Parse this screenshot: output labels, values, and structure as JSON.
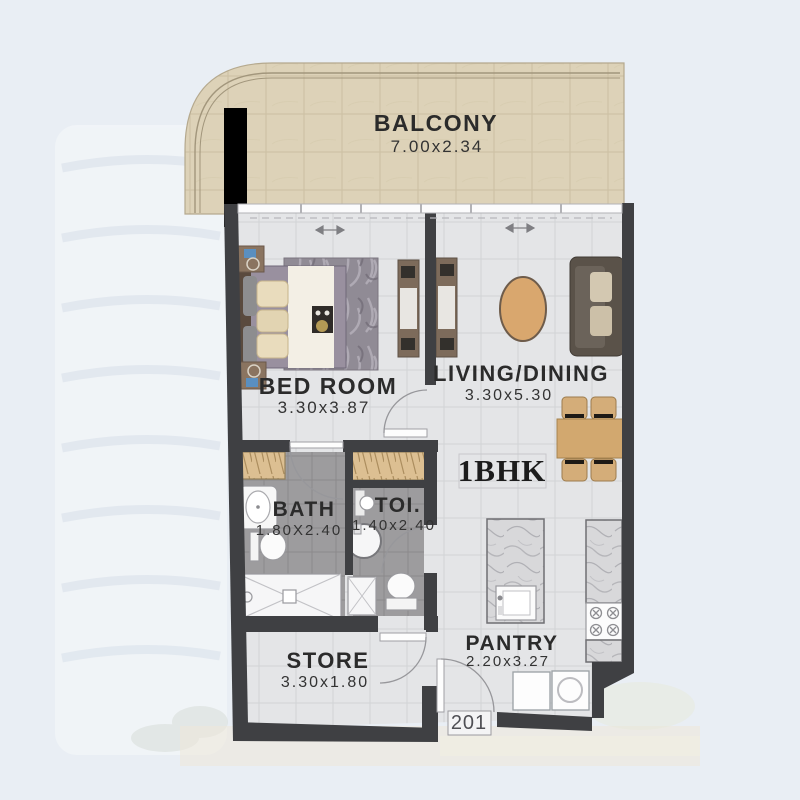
{
  "unit": {
    "type": "1BHK",
    "number": "201"
  },
  "rooms": {
    "balcony": {
      "name": "BALCONY",
      "dims": "7.00x2.34"
    },
    "bedroom": {
      "name": "BED ROOM",
      "dims": "3.30x3.87"
    },
    "living": {
      "name": "LIVING/DINING",
      "dims": "3.30x5.30"
    },
    "bath": {
      "name": "BATH",
      "dims": "1.80X2.40"
    },
    "toilet": {
      "name": "TOI.",
      "dims": "1.40x2.40"
    },
    "store": {
      "name": "STORE",
      "dims": "3.30x1.80"
    },
    "pantry": {
      "name": "PANTRY",
      "dims": "2.20x3.27"
    }
  },
  "colors": {
    "page_bg": "#e9eef4",
    "wall": "#3f4043",
    "column": "#000000",
    "balcony_floor": "#ddd2b8",
    "interior_floor": "#e4e5e7",
    "wet_floor": "#9d9c9e",
    "wood_accent": "#d2a86f",
    "text": "#2b2b2b"
  }
}
